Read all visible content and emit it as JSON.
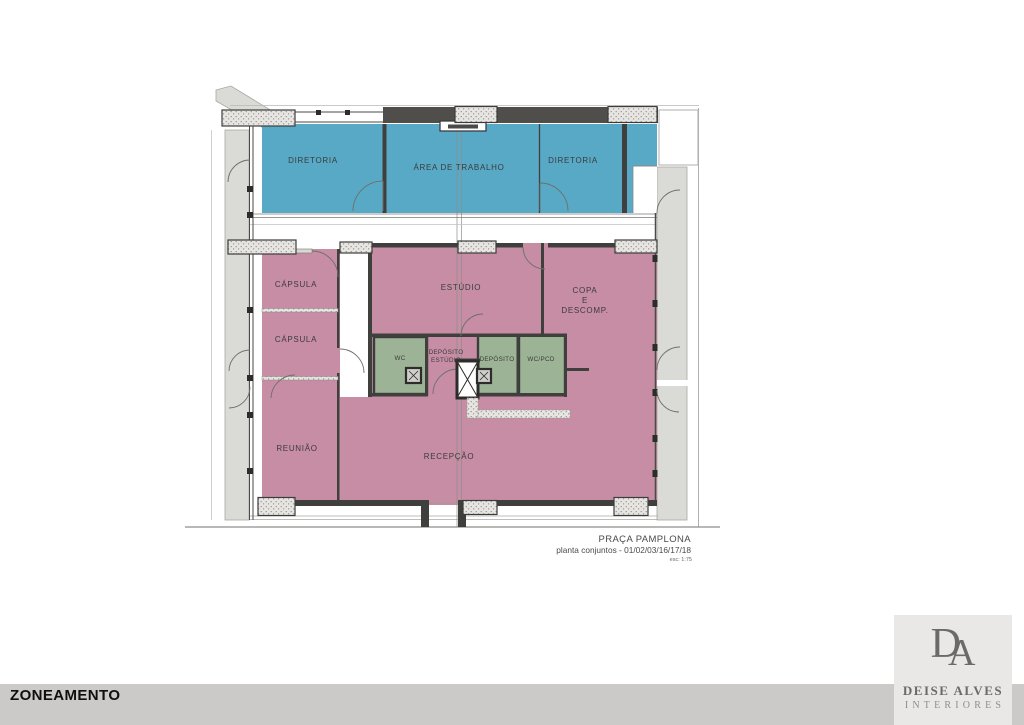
{
  "plan": {
    "rooms": {
      "diretoria_left": "DIRETORIA",
      "area_trabalho": "ÁREA DE TRABALHO",
      "diretoria_right": "DIRETORIA",
      "capsula_1": "CÁPSULA",
      "capsula_2": "CÁPSULA",
      "estudio": "ESTÚDIO",
      "copa_line1": "COPA",
      "copa_line2": "E",
      "copa_line3": "DESCOMP.",
      "wc": "WC",
      "deposito_estudio_line1": "DEPÓSITO",
      "deposito_estudio_line2": "ESTÚDIO",
      "deposito": "DEPÓSITO",
      "wc_pcd": "WC/PCD",
      "reuniao": "REUNIÃO",
      "recepcao": "RECEPÇÃO"
    },
    "title_block": {
      "project": "PRAÇA PAMPLONA",
      "subtitle": "planta conjuntos - 01/02/03/16/17/18",
      "scale": "esc: 1:75"
    },
    "colors": {
      "blue_zone": "#58a9c6",
      "pink_zone": "#c78da4",
      "green_zone": "#9db396",
      "wall_dark": "#4a4a48"
    }
  },
  "footer": {
    "label": "ZONEAMENTO"
  },
  "logo": {
    "monogram_d": "D",
    "monogram_a": "A",
    "name": "DEISE ALVES",
    "tagline": "INTERIORES"
  }
}
